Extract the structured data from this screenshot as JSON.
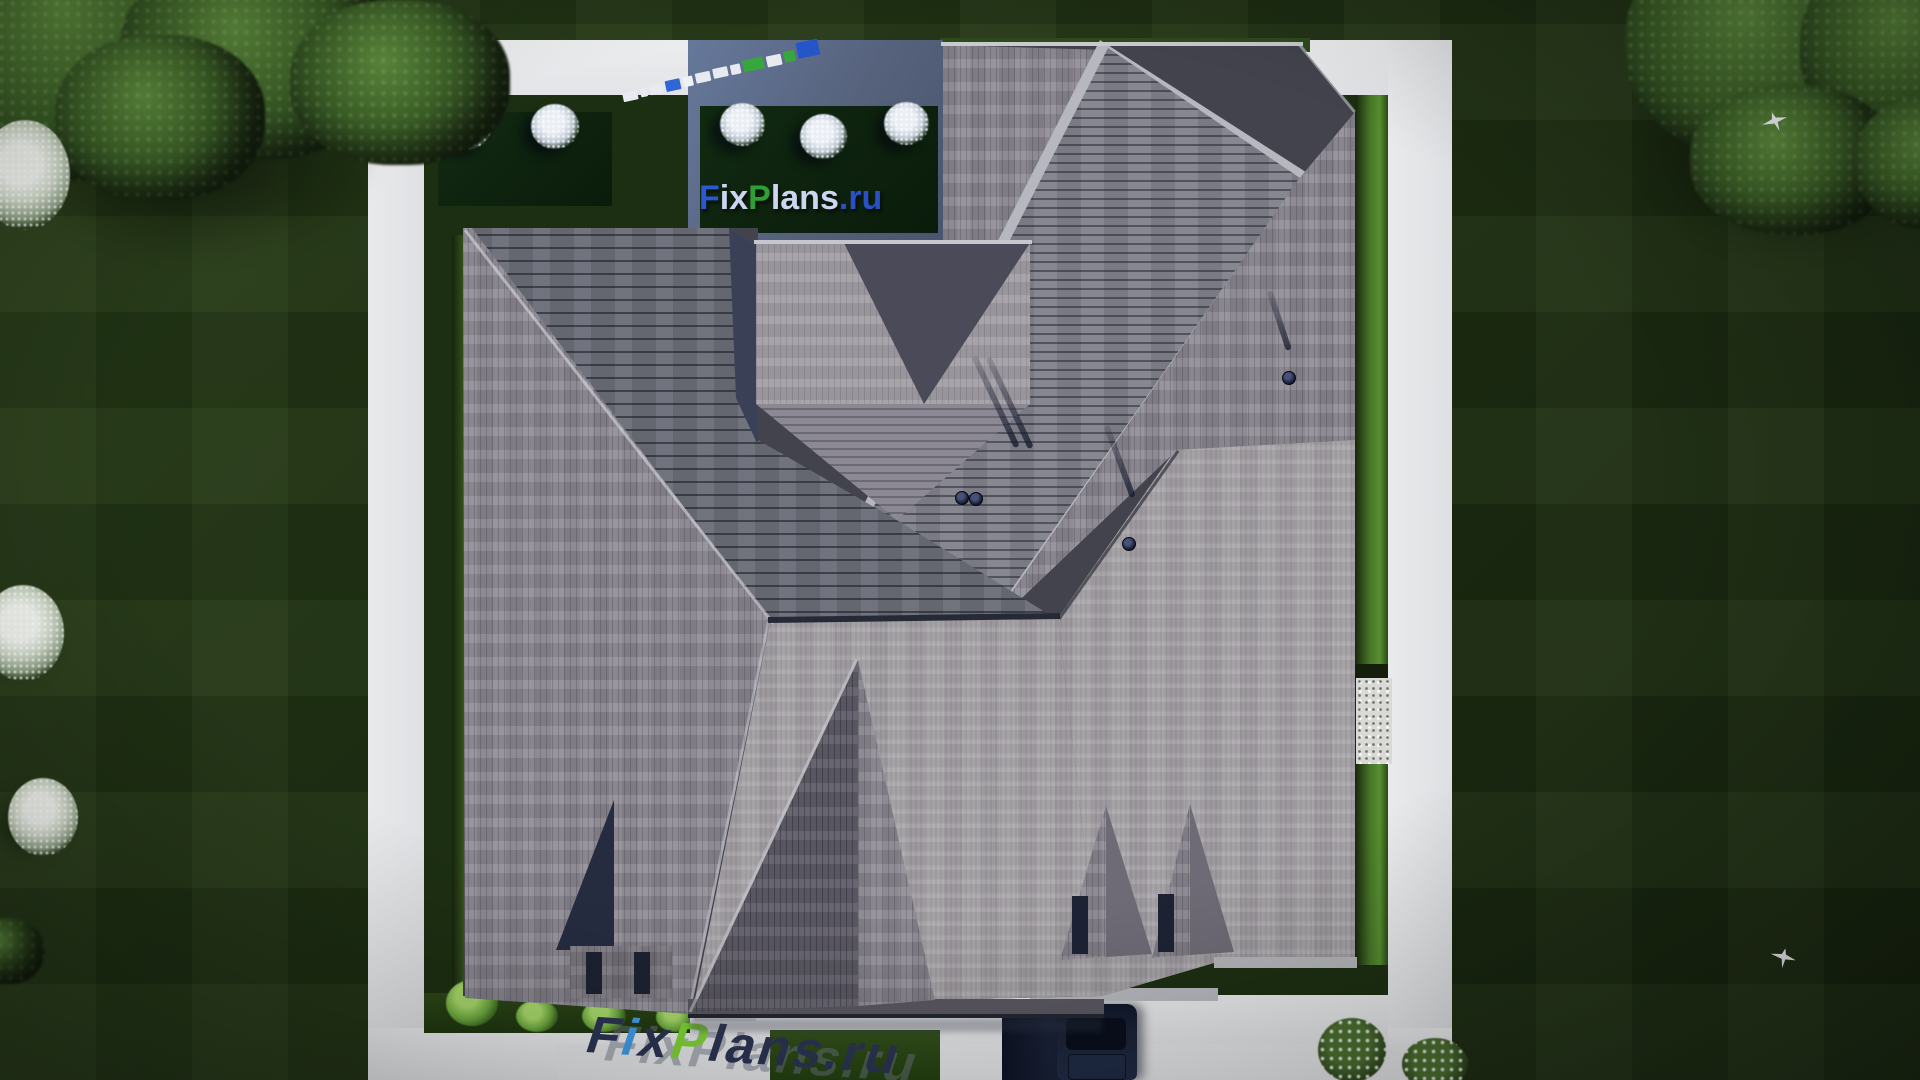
{
  "branding": {
    "site_logo": {
      "full_text": "FixPlans.ru",
      "segments": [
        {
          "text": "F",
          "color": "#2a59d2"
        },
        {
          "text": "ix",
          "color": "#ccd6f1"
        },
        {
          "text": "P",
          "color": "#2f9f35"
        },
        {
          "text": "lans",
          "color": "#ccd6f1"
        },
        {
          "text": ".ru",
          "color": "#2a50c6"
        }
      ]
    },
    "pavement_watermark": {
      "full_text": "FixPlans.ru",
      "segments": [
        {
          "text": "F",
          "color": "#2c3453"
        },
        {
          "text": "i",
          "color": "#429ce6"
        },
        {
          "text": "x",
          "color": "#2c3453"
        },
        {
          "text": "P",
          "color": "#80d435"
        },
        {
          "text": "lans",
          "color": "#2c3453"
        },
        {
          "text": ".ru",
          "color": "#2c3453"
        }
      ]
    },
    "mini_logo_blocks": [
      {
        "color": "#e7ebf1",
        "w": 15,
        "h": 9,
        "dy": 3
      },
      {
        "color": "#e7ebf1",
        "w": 7,
        "h": 9,
        "dy": 2
      },
      {
        "color": "#e7ebf1",
        "w": 13,
        "h": 10,
        "dy": 2
      },
      {
        "color": "#2f66d6",
        "w": 15,
        "h": 11,
        "dy": 1
      },
      {
        "color": "#eef1f5",
        "w": 10,
        "h": 10,
        "dy": 1
      },
      {
        "color": "#e7ebf1",
        "w": 15,
        "h": 10,
        "dy": 0
      },
      {
        "color": "#e7ebf1",
        "w": 15,
        "h": 10,
        "dy": -1
      },
      {
        "color": "#e7ebf1",
        "w": 10,
        "h": 10,
        "dy": -1
      },
      {
        "color": "#37a63c",
        "w": 21,
        "h": 12,
        "dy": -2
      },
      {
        "color": "#e7ebf1",
        "w": 15,
        "h": 11,
        "dy": -2
      },
      {
        "color": "#37a63c",
        "w": 11,
        "h": 11,
        "dy": -3
      },
      {
        "color": "#2456c8",
        "w": 22,
        "h": 16,
        "dy": -6
      }
    ]
  },
  "palette": {
    "lawn": "#1f3114",
    "path": "#e8e9eb",
    "roof_light": "#a8a4a9",
    "roof_mid": "#8d8993",
    "roof_dark_plank": "#696c76",
    "tower_shadow": "#4a4a58",
    "navy_shadow": "#3a4156",
    "hedge_bright": "#4f822c",
    "car_body": "#1b2335"
  }
}
